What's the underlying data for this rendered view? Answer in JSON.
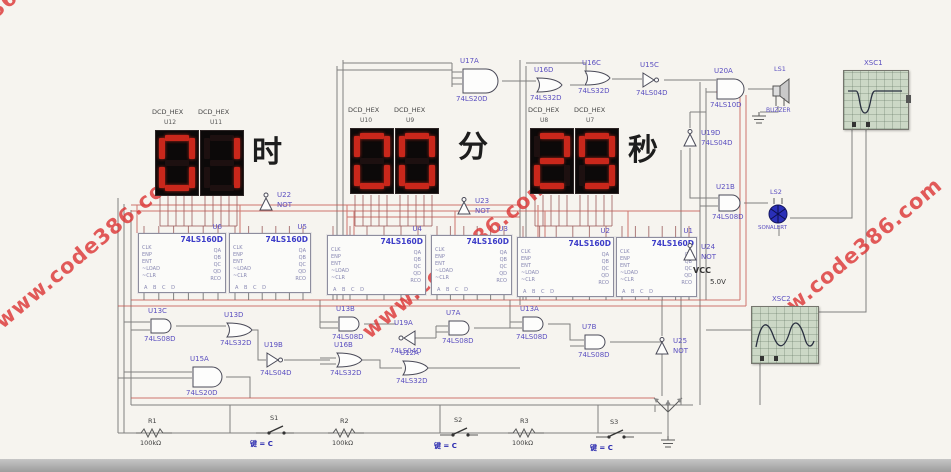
{
  "colors": {
    "watermark": "#dc3333",
    "segment_lit": "#c9271b",
    "display_bg": "#0c0909",
    "label": "#5b4fc0",
    "part": "#3c3cc8",
    "wire_dark": "#6b6b6b",
    "wire_red": "#c5554e",
    "wire_maroon": "#9b5b5b",
    "scope_screen": "#ccd8c6",
    "buzzer_blue": "#2a2fb8"
  },
  "watermark": {
    "text": "www.code386.com"
  },
  "clock": {
    "sections": [
      {
        "name": "hours",
        "unit": "时",
        "digits": [
          "0",
          "1"
        ],
        "chips": [
          {
            "type": "DCD_HEX",
            "ref": "U12"
          },
          {
            "type": "DCD_HEX",
            "ref": "U11"
          }
        ]
      },
      {
        "name": "minutes",
        "unit": "分",
        "digits": [
          "0",
          "0"
        ],
        "chips": [
          {
            "type": "DCD_HEX",
            "ref": "U10"
          },
          {
            "type": "DCD_HEX",
            "ref": "U9"
          }
        ]
      },
      {
        "name": "seconds",
        "unit": "秒",
        "digits": [
          "2",
          "9"
        ],
        "chips": [
          {
            "type": "DCD_HEX",
            "ref": "U8"
          },
          {
            "type": "DCD_HEX",
            "ref": "U7"
          }
        ]
      }
    ]
  },
  "counters": [
    {
      "ref": "U6",
      "part": "74LS160D"
    },
    {
      "ref": "U5",
      "part": "74LS160D"
    },
    {
      "ref": "U4",
      "part": "74LS160D"
    },
    {
      "ref": "U3",
      "part": "74LS160D"
    },
    {
      "ref": "U2",
      "part": "74LS160D"
    },
    {
      "ref": "U1",
      "part": "74LS160D"
    }
  ],
  "ic_pins": {
    "left": "CLK\nENP\nENT\n~LOAD\n~CLR",
    "right": "QA\nQB\nQC\nQD\nRCO",
    "bottom": "A B C D"
  },
  "gates": [
    {
      "ref": "U17A",
      "part": "74LS20D"
    },
    {
      "ref": "U16D",
      "part": "74LS32D"
    },
    {
      "ref": "U16C",
      "part": "74LS32D"
    },
    {
      "ref": "U15C",
      "part": "74LS04D"
    },
    {
      "ref": "U20A",
      "part": "74LS10D"
    },
    {
      "ref": "U19D",
      "part": "74LS04D"
    },
    {
      "ref": "U21B",
      "part": "74LS08D"
    },
    {
      "ref": "U22",
      "part": "NOT"
    },
    {
      "ref": "U23",
      "part": "NOT"
    },
    {
      "ref": "U24",
      "part": "NOT"
    },
    {
      "ref": "U13C",
      "part": "74LS08D"
    },
    {
      "ref": "U13D",
      "part": "74LS32D"
    },
    {
      "ref": "U19B",
      "part": "74LS04D"
    },
    {
      "ref": "U15A",
      "part": "74LS20D"
    },
    {
      "ref": "U13B",
      "part": "74LS08D"
    },
    {
      "ref": "U19A",
      "part": "74LS04D"
    },
    {
      "ref": "U16B",
      "part": "74LS32D"
    },
    {
      "ref": "U12A",
      "part": "74LS32D"
    },
    {
      "ref": "U7A",
      "part": "74LS08D"
    },
    {
      "ref": "U13A",
      "part": "74LS08D"
    },
    {
      "ref": "U7B",
      "part": "74LS08D"
    },
    {
      "ref": "U25",
      "part": "NOT"
    }
  ],
  "instruments": [
    {
      "ref": "XSC1"
    },
    {
      "ref": "XSC2"
    }
  ],
  "speaker": {
    "ref": "LS1",
    "part": "BUZZER"
  },
  "alarm": {
    "ref": "LS2",
    "part": "SONALERT"
  },
  "power": {
    "vcc": "VCC",
    "voltage": "5.0V"
  },
  "resistors": [
    {
      "ref": "R1",
      "value": "100kΩ"
    },
    {
      "ref": "R2",
      "value": "100kΩ"
    },
    {
      "ref": "R3",
      "value": "100kΩ"
    }
  ],
  "switches": [
    {
      "ref": "S1",
      "key": "键 = C"
    },
    {
      "ref": "S2",
      "key": "键 = C"
    },
    {
      "ref": "S3",
      "key": "键 = C"
    }
  ]
}
